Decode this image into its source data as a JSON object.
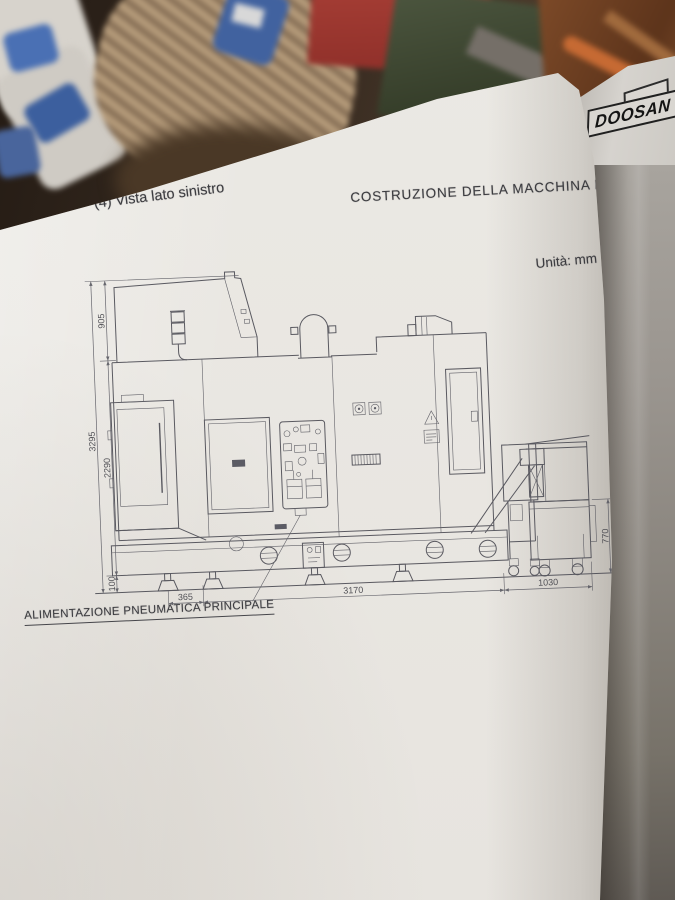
{
  "photo": {
    "background_logo": "DOOSAN"
  },
  "page": {
    "section_heading": "(4) Vista lato sinistro",
    "doc_title": "COSTRUZIONE DELLA MACCHINA B-5",
    "units_label": "Unità: mm",
    "footer_caption": "ALIMENTAZIONE PNEUMATICA PRINCIPALE"
  },
  "drawing": {
    "type": "technical-side-view",
    "dimensions": {
      "total_height": "3295",
      "top_section_height": "905",
      "body_height": "2290",
      "base_height": "100",
      "left_offset": "365",
      "main_length": "3170",
      "conveyor_extension": "1030",
      "cart_height": "770"
    }
  }
}
